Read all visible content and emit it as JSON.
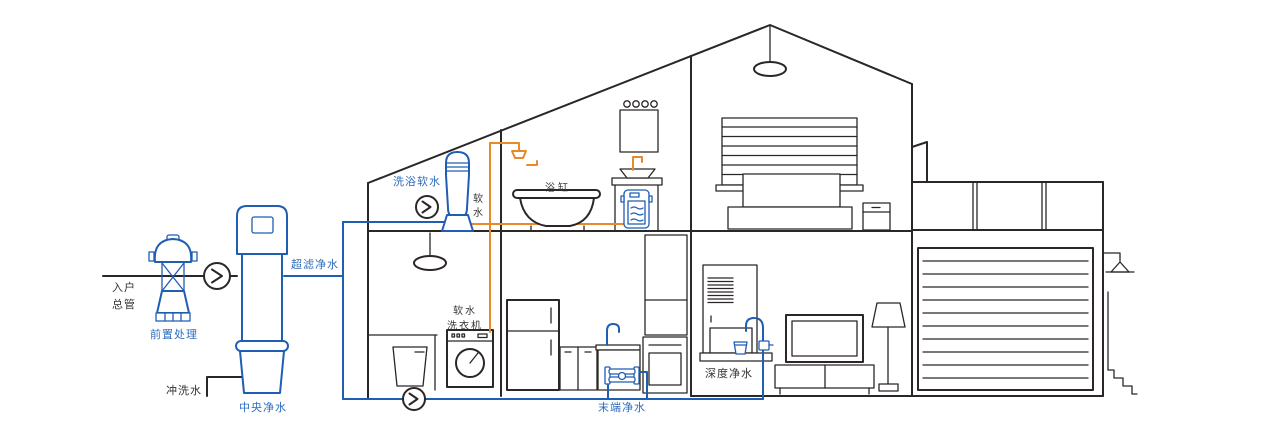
{
  "colors": {
    "line": "#2b2627",
    "blue": "#1f5eb2",
    "orange": "#e8892c",
    "label_blue": "#2e6cbd",
    "label_dark": "#333333"
  },
  "labels": {
    "inlet_main": "入户\n总管",
    "pre_treatment": "前置处理",
    "flush_water": "冲洗水",
    "central_purifier": "中央净水",
    "ultra_filtration": "超滤净水",
    "bath_softener": "洗浴软水",
    "soft_water": "软\n水",
    "bathtub": "浴缸",
    "soft_water_washer": "软水\n洗衣机",
    "terminal_purifier": "末端净水",
    "deep_purifier": "深度净水"
  },
  "icons": {
    "flow_direction": "chevron-right-in-circle",
    "ceiling_lamp": "pendant-lamp",
    "shower": "shower-head",
    "outdoor_lamp": "wall-lamp",
    "floor_lamp": "standing-lamp"
  }
}
